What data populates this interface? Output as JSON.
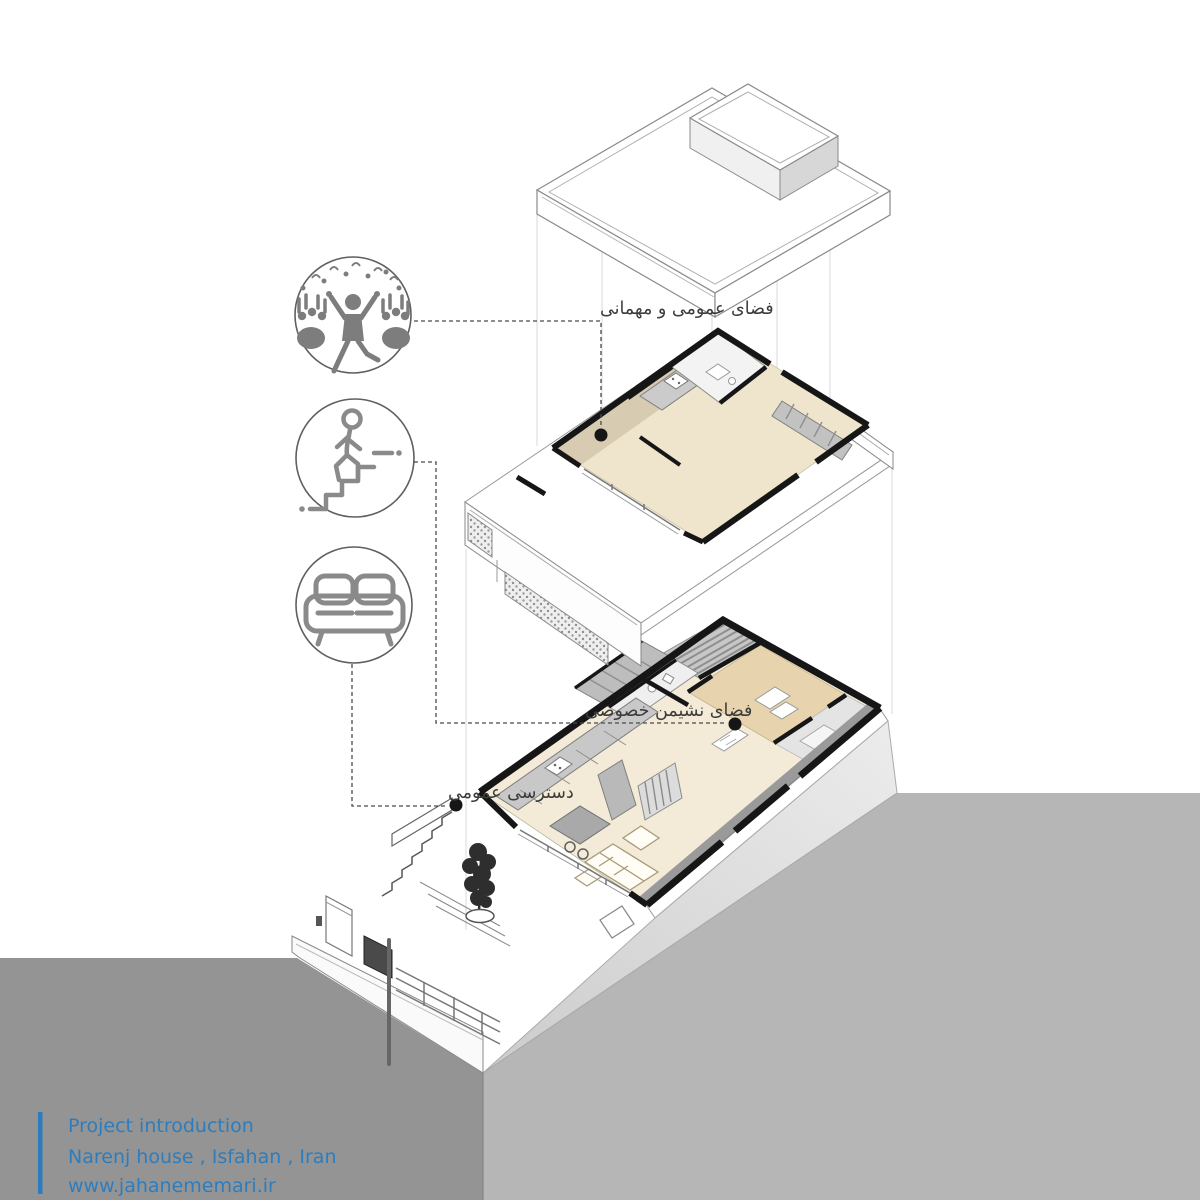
{
  "title": "Narenj house exploded axonometric diagram",
  "annotations": {
    "public_guest_space": "فضای عمومی و مهمانی",
    "private_living_space": "فضای نشیمن خصوصی",
    "public_access": "دسترسی عمومی"
  },
  "legend_icons": [
    {
      "name": "party-crowd-icon",
      "meaning": "public / guest gathering space"
    },
    {
      "name": "person-on-stairs-icon",
      "meaning": "circulation / stairs"
    },
    {
      "name": "sofa-icon",
      "meaning": "living space"
    }
  ],
  "footer": {
    "line1": "Project introduction",
    "line2": "Narenj house , Isfahan , Iran",
    "line3": "www.jahanememari.ir"
  },
  "colors": {
    "accent_blue": "#2d7dbe",
    "ground_dark_gray": "#949494",
    "ground_light_gray": "#b6b6b6",
    "floor_beige_light": "#f3ead7",
    "floor_beige_upper": "#eee5cc",
    "floor_tan_private": "#e7d4ae",
    "wall_tan": "#d7cbb1",
    "cut_wall_black": "#161616",
    "icon_gray": "#7d7d7d",
    "leader_line": "#4a4a4a"
  }
}
